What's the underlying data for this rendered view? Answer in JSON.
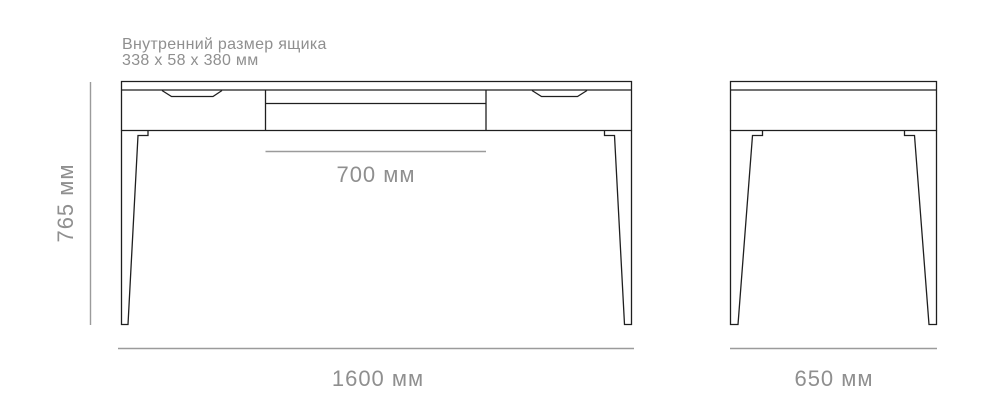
{
  "colors": {
    "background": "#ffffff",
    "outline": "#1f1f1f",
    "dimension_line": "#9b9b9b",
    "dimension_text": "#8f8f8f"
  },
  "note": {
    "title": "Внутренний размер ящика",
    "value": "338 x 58 x 380 мм"
  },
  "dimensions": {
    "height": "765 мм",
    "drawer_width": "700 мм",
    "width": "1600 мм",
    "depth": "650 мм"
  }
}
